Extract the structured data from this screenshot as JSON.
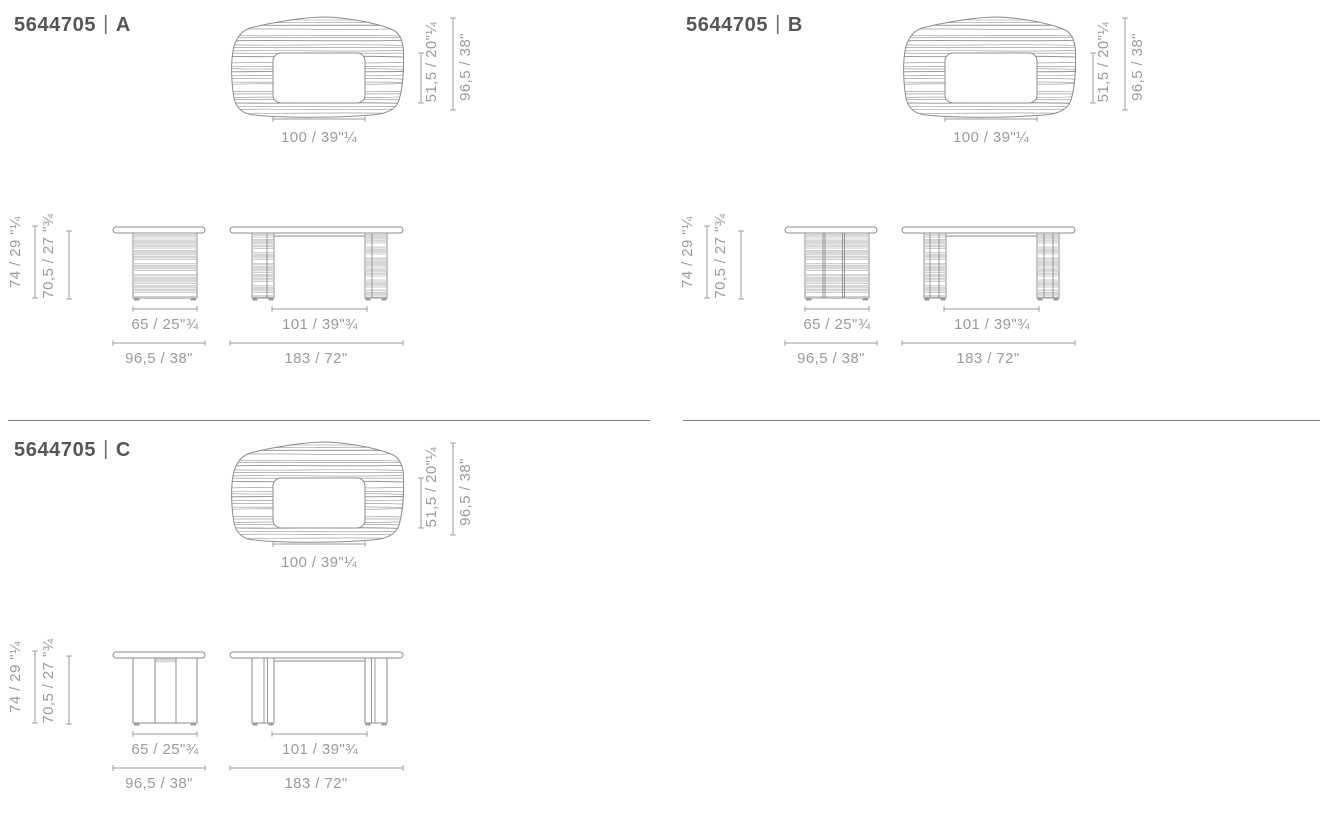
{
  "sheet": {
    "background": "#ffffff"
  },
  "colors": {
    "title_text": "#55565a",
    "drawing_line": "#8c8d8f",
    "dimension": "#9b9b9b",
    "stripe_fill": "#d8d8d8",
    "divider": "#7f7f7f"
  },
  "panels": [
    {
      "code": "5644705",
      "separator": "|",
      "variant": "A",
      "top_view": {
        "width_label": "100 / 39\"¼",
        "cutout_label": "51,5 / 20\"¼",
        "depth_label": "96,5 / 38\""
      },
      "elevation": {
        "height_label": "74 / 29 \"¼",
        "clearance_label": "70,5 / 27 \"¾",
        "base_label": "65 / 25\"¾",
        "side_label": "96,5 / 38\"",
        "span_label": "101 / 39\"¾",
        "length_label": "183 / 72\""
      }
    },
    {
      "code": "5644705",
      "separator": "|",
      "variant": "B",
      "top_view": {
        "width_label": "100 / 39\"¼",
        "cutout_label": "51,5 / 20\"¼",
        "depth_label": "96,5 / 38\""
      },
      "elevation": {
        "height_label": "74 / 29 \"¼",
        "clearance_label": "70,5 / 27 \"¾",
        "base_label": "65 / 25\"¾",
        "side_label": "96,5 / 38\"",
        "span_label": "101 / 39\"¾",
        "length_label": "183 / 72\""
      }
    },
    {
      "code": "5644705",
      "separator": "|",
      "variant": "C",
      "top_view": {
        "width_label": "100 / 39\"¼",
        "cutout_label": "51,5 / 20\"¼",
        "depth_label": "96,5 / 38\""
      },
      "elevation": {
        "height_label": "74 / 29 \"¼",
        "clearance_label": "70,5 / 27 \"¾",
        "base_label": "65 / 25\"¾",
        "side_label": "96,5 / 38\"",
        "span_label": "101 / 39\"¾",
        "length_label": "183 / 72\""
      }
    }
  ]
}
